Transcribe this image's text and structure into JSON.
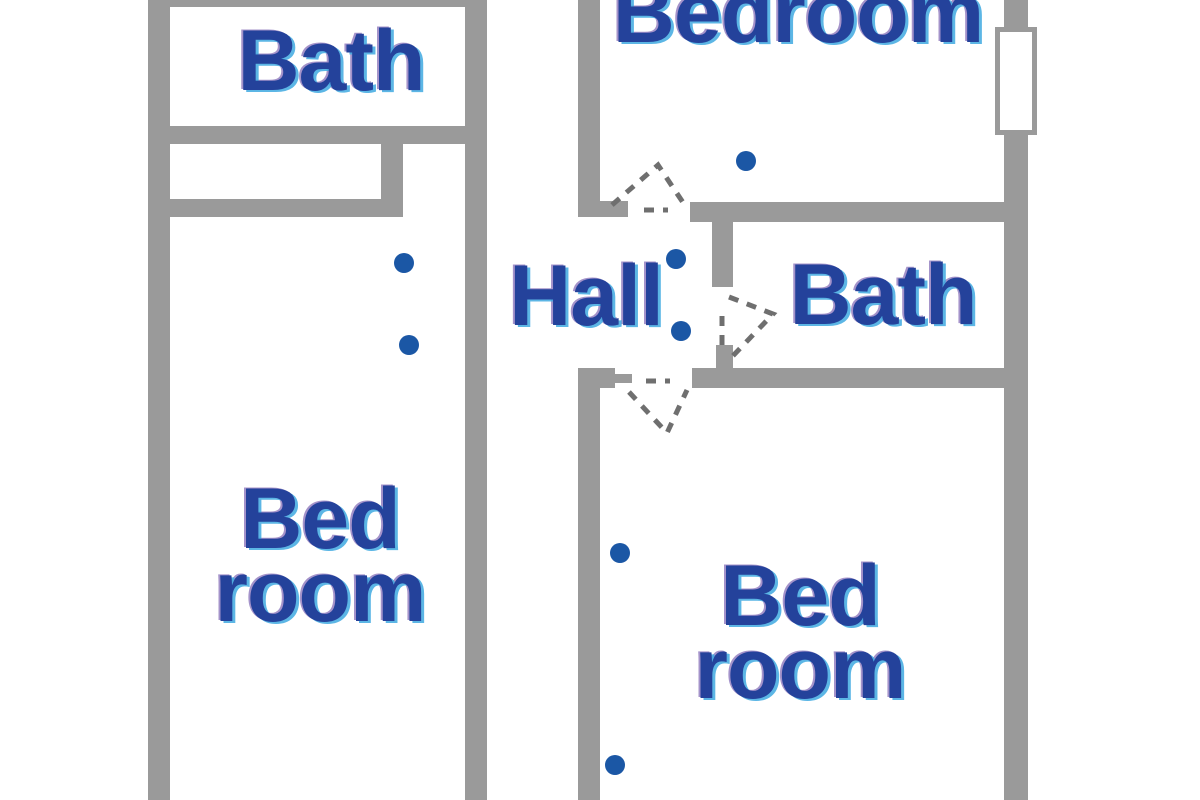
{
  "canvas": {
    "width": 1200,
    "height": 800
  },
  "colors": {
    "background": "#ffffff",
    "wall_gray": "#9a9a9a",
    "door_dash_gray": "#6f6f6f",
    "dot_blue": "#1b57a5",
    "label_blue": "#24429b"
  },
  "rooms": [
    {
      "id": "bath-left",
      "label": "Bath",
      "cx": 331,
      "cy": 61,
      "two_line": false
    },
    {
      "id": "bedroom-left",
      "label": "Bed\nroom",
      "cx": 320,
      "cy": 556,
      "two_line": true
    },
    {
      "id": "hall",
      "label": "Hall",
      "cx": 586,
      "cy": 296,
      "two_line": false
    },
    {
      "id": "bedroom-top",
      "label": "Bedroom",
      "cx": 798,
      "cy": 13,
      "two_line": false
    },
    {
      "id": "bath-right",
      "label": "Bath",
      "cx": 883,
      "cy": 295,
      "two_line": false
    },
    {
      "id": "bedroom-bottom",
      "label": "Bed\nroom",
      "cx": 800,
      "cy": 633,
      "two_line": true
    }
  ],
  "walls": [
    {
      "id": "left-section-top",
      "x": 148,
      "y": 0,
      "w": 339,
      "h": 7
    },
    {
      "id": "left-outer",
      "x": 148,
      "y": 0,
      "w": 22,
      "h": 800
    },
    {
      "id": "left-section-right",
      "x": 465,
      "y": 0,
      "w": 22,
      "h": 800
    },
    {
      "id": "bath-left-bottom",
      "x": 148,
      "y": 126,
      "w": 339,
      "h": 18
    },
    {
      "id": "closet-right",
      "x": 381,
      "y": 144,
      "w": 22,
      "h": 73
    },
    {
      "id": "closet-bottom",
      "x": 148,
      "y": 199,
      "w": 255,
      "h": 18
    },
    {
      "id": "bedroom-top-left-wall",
      "x": 578,
      "y": 0,
      "w": 22,
      "h": 217
    },
    {
      "id": "top-door-left-jamb",
      "x": 598,
      "y": 201,
      "w": 30,
      "h": 16
    },
    {
      "id": "bedroom-top-bottom-wall",
      "x": 690,
      "y": 202,
      "w": 338,
      "h": 20
    },
    {
      "id": "hall-bath-divider",
      "x": 712,
      "y": 222,
      "w": 21,
      "h": 65
    },
    {
      "id": "bath-door-lower-jamb",
      "x": 716,
      "y": 345,
      "w": 17,
      "h": 25
    },
    {
      "id": "bath-right-bottom-wall",
      "x": 692,
      "y": 368,
      "w": 336,
      "h": 20
    },
    {
      "id": "bottom-door-left-piece",
      "x": 578,
      "y": 368,
      "w": 37,
      "h": 20
    },
    {
      "id": "bottom-door-left-jamb",
      "x": 615,
      "y": 374,
      "w": 17,
      "h": 9
    },
    {
      "id": "bedroom-bottom-left-wall",
      "x": 578,
      "y": 368,
      "w": 22,
      "h": 432
    },
    {
      "id": "right-outer-top",
      "x": 1004,
      "y": 0,
      "w": 24,
      "h": 27
    },
    {
      "id": "right-outer-main",
      "x": 1004,
      "y": 135,
      "w": 24,
      "h": 665
    }
  ],
  "window_symbol": {
    "x": 995,
    "y": 27,
    "w": 42,
    "h": 108
  },
  "dots": [
    {
      "id": "bedroom-left-upper",
      "cx": 404,
      "cy": 263,
      "d": 20
    },
    {
      "id": "bedroom-left-lower",
      "cx": 409,
      "cy": 345,
      "d": 20
    },
    {
      "id": "bedroom-top",
      "cx": 746,
      "cy": 161,
      "d": 20
    },
    {
      "id": "hall-upper",
      "cx": 676,
      "cy": 259,
      "d": 20
    },
    {
      "id": "hall-lower",
      "cx": 681,
      "cy": 331,
      "d": 20
    },
    {
      "id": "bedroom-bottom-upper",
      "cx": 620,
      "cy": 553,
      "d": 20
    },
    {
      "id": "bedroom-bottom-lower",
      "cx": 615,
      "cy": 765,
      "d": 20
    }
  ],
  "door_swings": [
    {
      "id": "top-bedroom-door",
      "paths": [
        "M612,205 L658,165 L684,204",
        "M644,210 L668,210"
      ]
    },
    {
      "id": "right-bath-door",
      "paths": [
        "M729,297 L773,314 L728,361",
        "M722,316 L722,354"
      ]
    },
    {
      "id": "bottom-bedroom-door",
      "paths": [
        "M629,392 L667,433 L687,390",
        "M646,381 L670,381"
      ]
    }
  ],
  "swing_style": {
    "stroke_width": 5,
    "dash": "10 9"
  }
}
